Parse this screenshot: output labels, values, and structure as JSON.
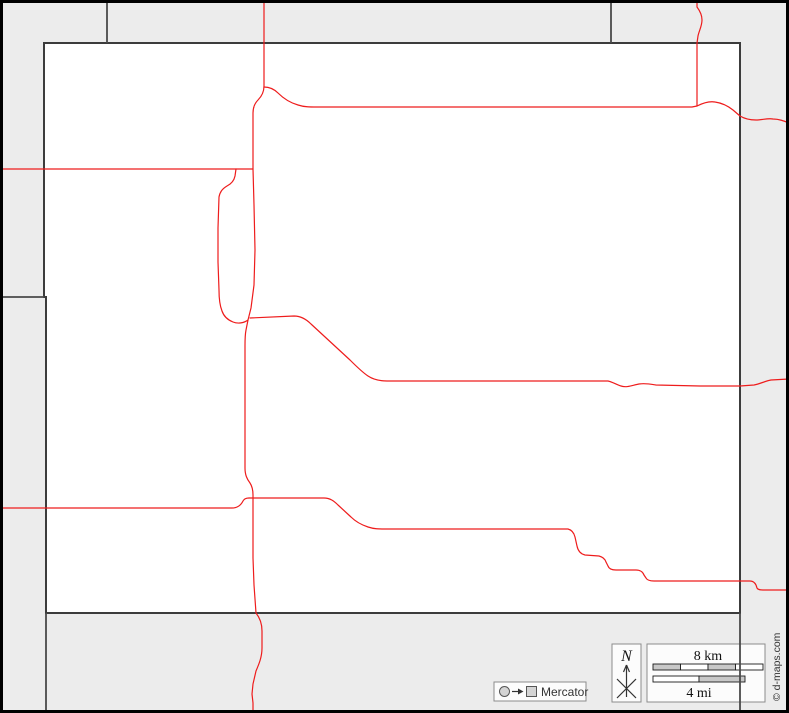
{
  "map": {
    "width": 789,
    "height": 713,
    "colors": {
      "background": "#ececec",
      "county_fill": "#ffffff",
      "boundary": "#3c3c3c",
      "neighbor": "#4a4a4a",
      "road": "#ee1c1c",
      "frame": "#000000"
    },
    "county_path": "M 44 43 L 740 43 L 740 613 L 46 613 L 46 297 L 44 297 Z",
    "neighbor_lines": [
      {
        "name": "top-left-vertical",
        "d": "M 107 0 L 107 43"
      },
      {
        "name": "top-right-vertical",
        "d": "M 611 0 L 611 43"
      },
      {
        "name": "west-horizontal",
        "d": "M 0 297 L 44 297"
      },
      {
        "name": "south-left-vertical",
        "d": "M 46 613 L 46 713"
      },
      {
        "name": "south-right-vertical",
        "d": "M 740 613 L 740 713"
      }
    ],
    "roads": [
      {
        "name": "north-south-main",
        "d": "M 264 0 L 264 44 L 264 86 C 264 93 261 97 258 100 C 254 104 253 108 253 113 L 253 169 L 254 205 L 255 250 L 254 285 L 251 308 L 248 320 L 246 330 C 245 335 245 340 245 346 L 245 468 C 245 475 247 479 250 483 C 252 486 253 490 253 495 L 253 558 L 254 585 L 256 613 C 260 618 262 624 262 631 L 262 648 C 262 657 259 664 256 671 L 253 684 L 252 694 L 253 703 L 253 713"
      },
      {
        "name": "west-horizontal",
        "d": "M 0 169 L 253 169"
      },
      {
        "name": "west-loop",
        "d": "M 236 169 L 235 176 C 234 181 231 184 227 186 C 222 189 220 192 219 197 L 218 228 L 218 262 L 219 290 C 219 299 220 306 222 311 C 224 317 228 320 233 322 C 238 324 244 323 248 320"
      },
      {
        "name": "northeast-horizontal",
        "d": "M 264 87 C 270 87 274 89 278 93 C 284 99 291 103 298 105 C 304 107 310 107 317 107 L 692 107 L 697 106 C 703 103 709 101 715 102 C 722 103 728 106 733 110 L 740 116 C 745 119 750 120 756 120 C 762 120 768 118 773 119 C 779 119 784 121 789 123"
      },
      {
        "name": "north-entry",
        "d": "M 697 0 L 697 7 C 700 11 702 15 702 20 C 702 26 699 31 698 36 L 697 43 L 697 106"
      },
      {
        "name": "east-central",
        "d": "M 250 318 L 294 316 C 301 316 306 319 311 324 L 350 360 C 356 366 362 372 368 376 C 374 380 380 381 387 381 L 608 381 C 613 382 617 385 621 386 C 627 388 633 385 639 384 C 645 383 650 384 656 385 L 700 386 L 740 386 L 754 385 C 760 384 765 381 771 380 L 789 379"
      },
      {
        "name": "southwest-horizontal",
        "d": "M 0 508 L 232 508 C 238 508 241 505 243 501 C 244 499 246 498 249 498"
      },
      {
        "name": "southeast-stepped",
        "d": "M 249 498 L 324 498 C 330 498 334 501 338 505 L 351 517 C 356 522 362 525 368 527 C 374 529 379 529 385 529 L 568 529 C 572 530 574 533 575 537 L 577 546 C 578 551 581 554 585 555 L 599 556 C 603 557 605 559 606 562 L 608 566 C 609 569 612 570 616 570 L 636 570 C 640 570 643 572 644 575 L 646 578 C 647 580 650 581 654 581 L 750 581 C 753 581 755 583 756 585 L 757 588 C 758 590 761 590 764 590 L 789 590"
      }
    ]
  },
  "legend": {
    "projection": {
      "label": "Mercator"
    },
    "compass": {
      "label": "N"
    },
    "scale": {
      "km_label": "8 km",
      "mi_label": "4 mi",
      "km_bar": {
        "x": 653,
        "y": 664,
        "width": 110,
        "height": 6,
        "segments": [
          "#c8c8c8",
          "#ffffff",
          "#c8c8c8",
          "#ffffff"
        ]
      },
      "mi_bar": {
        "x": 653,
        "y": 676,
        "width": 92,
        "height": 6,
        "segments": [
          "#ffffff",
          "#c8c8c8"
        ]
      }
    },
    "credit": "© d-maps.com"
  }
}
